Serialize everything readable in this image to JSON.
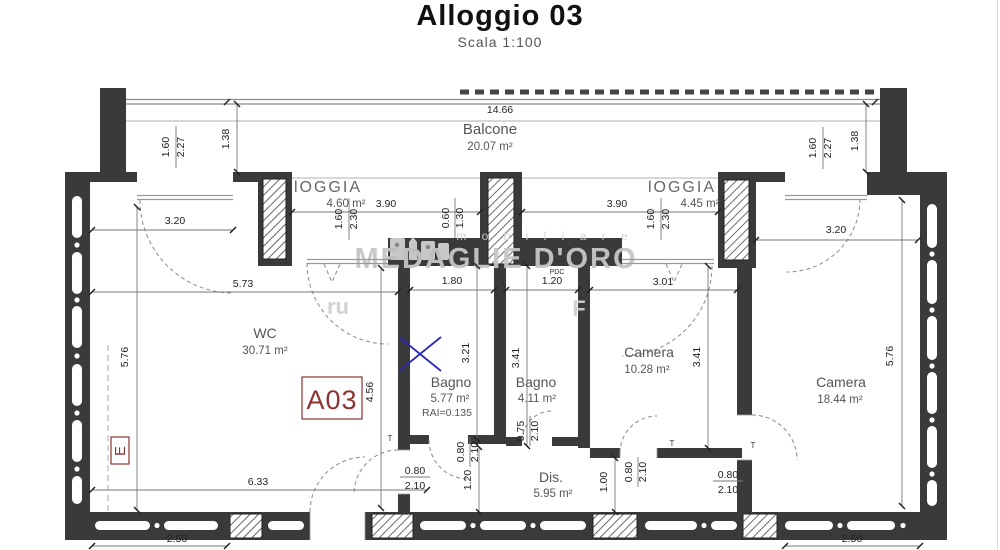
{
  "header": {
    "title": "Alloggio 03",
    "subtitle": "Scala 1:100"
  },
  "plan": {
    "unit_label": "A03",
    "section_label": "E",
    "pdc_label": "PDC",
    "t_label": "T",
    "watermark": {
      "logo": "medaglie-doro-monuments-logo",
      "brand_small": "m o b i l i a r e",
      "brand_large": "MEDAGLIE D'ORO",
      "fragment_left": "ru",
      "fragment_right": "F"
    },
    "rooms": [
      {
        "name": "Balcone",
        "area": "20.07 m²"
      },
      {
        "name": "lOGGIA",
        "area": "4.60 m²"
      },
      {
        "name": "lOGGIA",
        "area": "4.45 m²"
      },
      {
        "name": "WC",
        "area": "30.71 m²"
      },
      {
        "name": "Bagno",
        "area": "5.77 m²",
        "note": "RAI=0.135"
      },
      {
        "name": "Bagno",
        "area": "4.11 m²"
      },
      {
        "name": "Camera",
        "area": "10.28 m²"
      },
      {
        "name": "Camera",
        "area": "18.44 m²"
      },
      {
        "name": "Dis.",
        "area": "5.95 m²"
      }
    ],
    "dims": {
      "balcony_width": "14.66",
      "balcony_depth_left": "1.38",
      "balcony_depth_right": "1.38",
      "win_left_w": "1.60",
      "win_left_h": "2.27",
      "win_right_w": "1.60",
      "win_right_h": "2.27",
      "wc_window_top": "3.20",
      "camera2_window_top": "3.20",
      "loggia_left_len": "3.90",
      "loggia_right_len": "3.90",
      "loggia_left_win_w": "1.60",
      "loggia_left_win_h": "2.30",
      "loggia_right_win_w": "1.60",
      "loggia_right_win_h": "2.30",
      "pillar_w": "0.60",
      "pillar_h": "1.30",
      "wc_width_top": "5.73",
      "hall_opening": "1.80",
      "bagno2_width": "1.20",
      "camera1_width": "3.01",
      "wc_height_left": "5.76",
      "wc_height_mid": "4.56",
      "bagno1_height": "3.21",
      "bagno2_height": "3.41",
      "camera1_height": "3.41",
      "camera2_height": "5.76",
      "wc_width_bottom": "6.33",
      "corridor_width": "1.20",
      "camera1_bottom": "1.00",
      "door_a_w": "0.80",
      "door_a_h": "2.10",
      "door_b_w": "0.80",
      "door_b_h": "2.10",
      "door_c_w": "0.75",
      "door_c_h": "2.10",
      "door_d_w": "0.80",
      "door_d_h": "2.10",
      "door_e_w": "0.80",
      "door_e_h": "2.10",
      "bottom_left": "2.50",
      "bottom_right": "2.50"
    },
    "colors": {
      "wall": "#3a3a3a",
      "annotation_red": "#8d3333",
      "marker_blue": "#2b2bb4",
      "watermark_gray": "#c6c6c6"
    }
  }
}
